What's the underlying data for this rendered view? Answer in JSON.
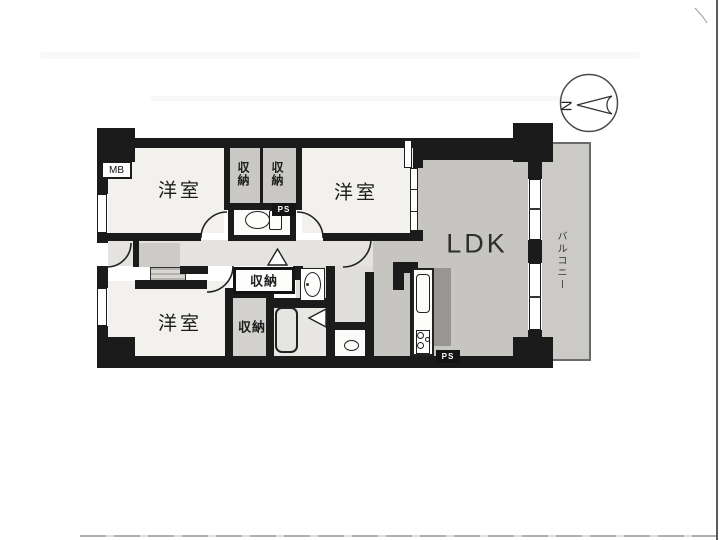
{
  "plan": {
    "rooms": {
      "bedroom1": {
        "label": "洋室"
      },
      "bedroom2": {
        "label": "洋室"
      },
      "bedroom3": {
        "label": "洋室"
      },
      "ldk": {
        "label": "LDK"
      },
      "balcony": {
        "label": "バルコニー"
      },
      "closet_top_left": {
        "label": "収納"
      },
      "closet_top_right": {
        "label": "収納"
      },
      "closet_hall": {
        "label": "収納"
      },
      "closet_bottom": {
        "label": "収納"
      }
    },
    "annotations": {
      "meter_box": "MB",
      "pipe_space_top": "PS",
      "pipe_space_bottom": "PS",
      "compass_north": "N"
    },
    "colors": {
      "wall": "#1b1b1b",
      "room_floor": "#f2f1ed",
      "ldk_floor": "#c6c5c2",
      "hall_floor": "#e4e3e0",
      "corridor_floor": "#dfdedb",
      "closet_floor": "#c9c8c5",
      "closet_bottom_floor": "#d2d1ce",
      "entrance_floor": "#cccbc8",
      "bath_floor": "#e8e7e4",
      "balcony_floor": "#cbcac7",
      "kitchen_dark": "#979694",
      "white_room": "#fbfbf9"
    }
  }
}
